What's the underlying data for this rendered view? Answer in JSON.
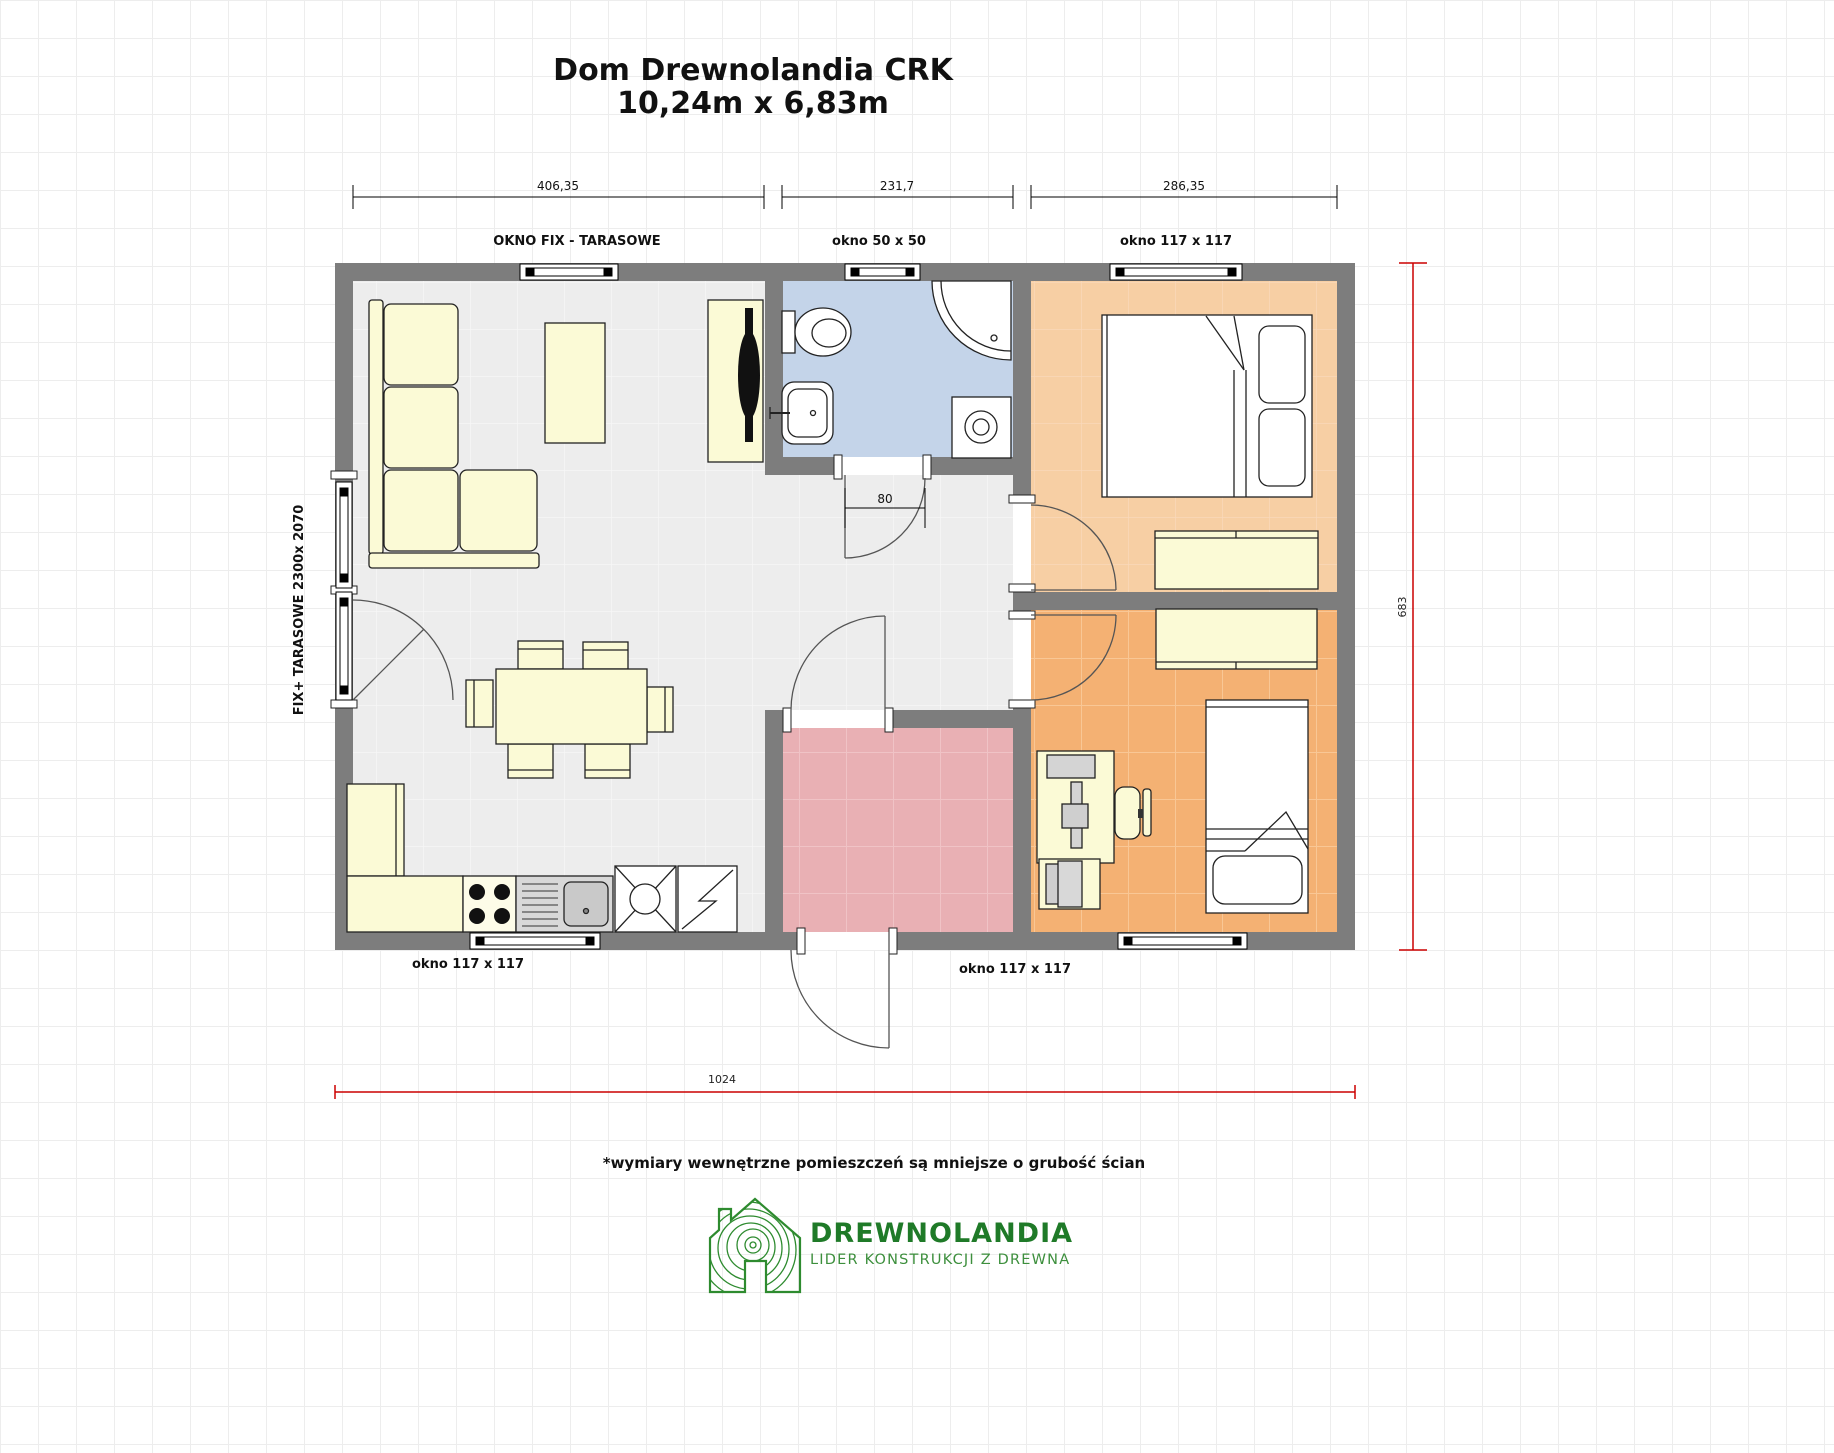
{
  "title": {
    "line1": "Dom Drewnolandia CRK",
    "line2": "10,24m x 6,83m"
  },
  "dims": {
    "living_width": "406,35",
    "middle_width": "231,7",
    "bedroom_width": "286,35",
    "bath_door_width": "80",
    "height_total": "683",
    "width_total": "1024"
  },
  "labels": {
    "window_top_left": "OKNO FIX - TARASOWE",
    "window_top_middle": "okno 50 x 50",
    "window_top_right": "okno 117 x 117",
    "window_left_side": "FIX+ TARASOWE 2300x 2070",
    "window_bottom_left": "okno 117 x 117",
    "window_bottom_right": "okno 117 x 117"
  },
  "note": "*wymiary wewnętrzne pomieszczeń są mniejsze o grubość ścian",
  "logo": {
    "name": "DREWNOLANDIA",
    "tagline": "LIDER KONSTRUKCJI Z DREWNA"
  },
  "colors": {
    "wall": "#7d7d7d",
    "living_floor": "#ededed",
    "bathroom_floor": "#c4d4e9",
    "bedroom1_floor": "#f7cfa4",
    "bedroom2_floor": "#f4b173",
    "vestibule_floor": "#e9b0b4",
    "furniture_cream": "#fbfad6",
    "dimension_red": "#cc0000",
    "logo_green": "#2e8b2f"
  }
}
